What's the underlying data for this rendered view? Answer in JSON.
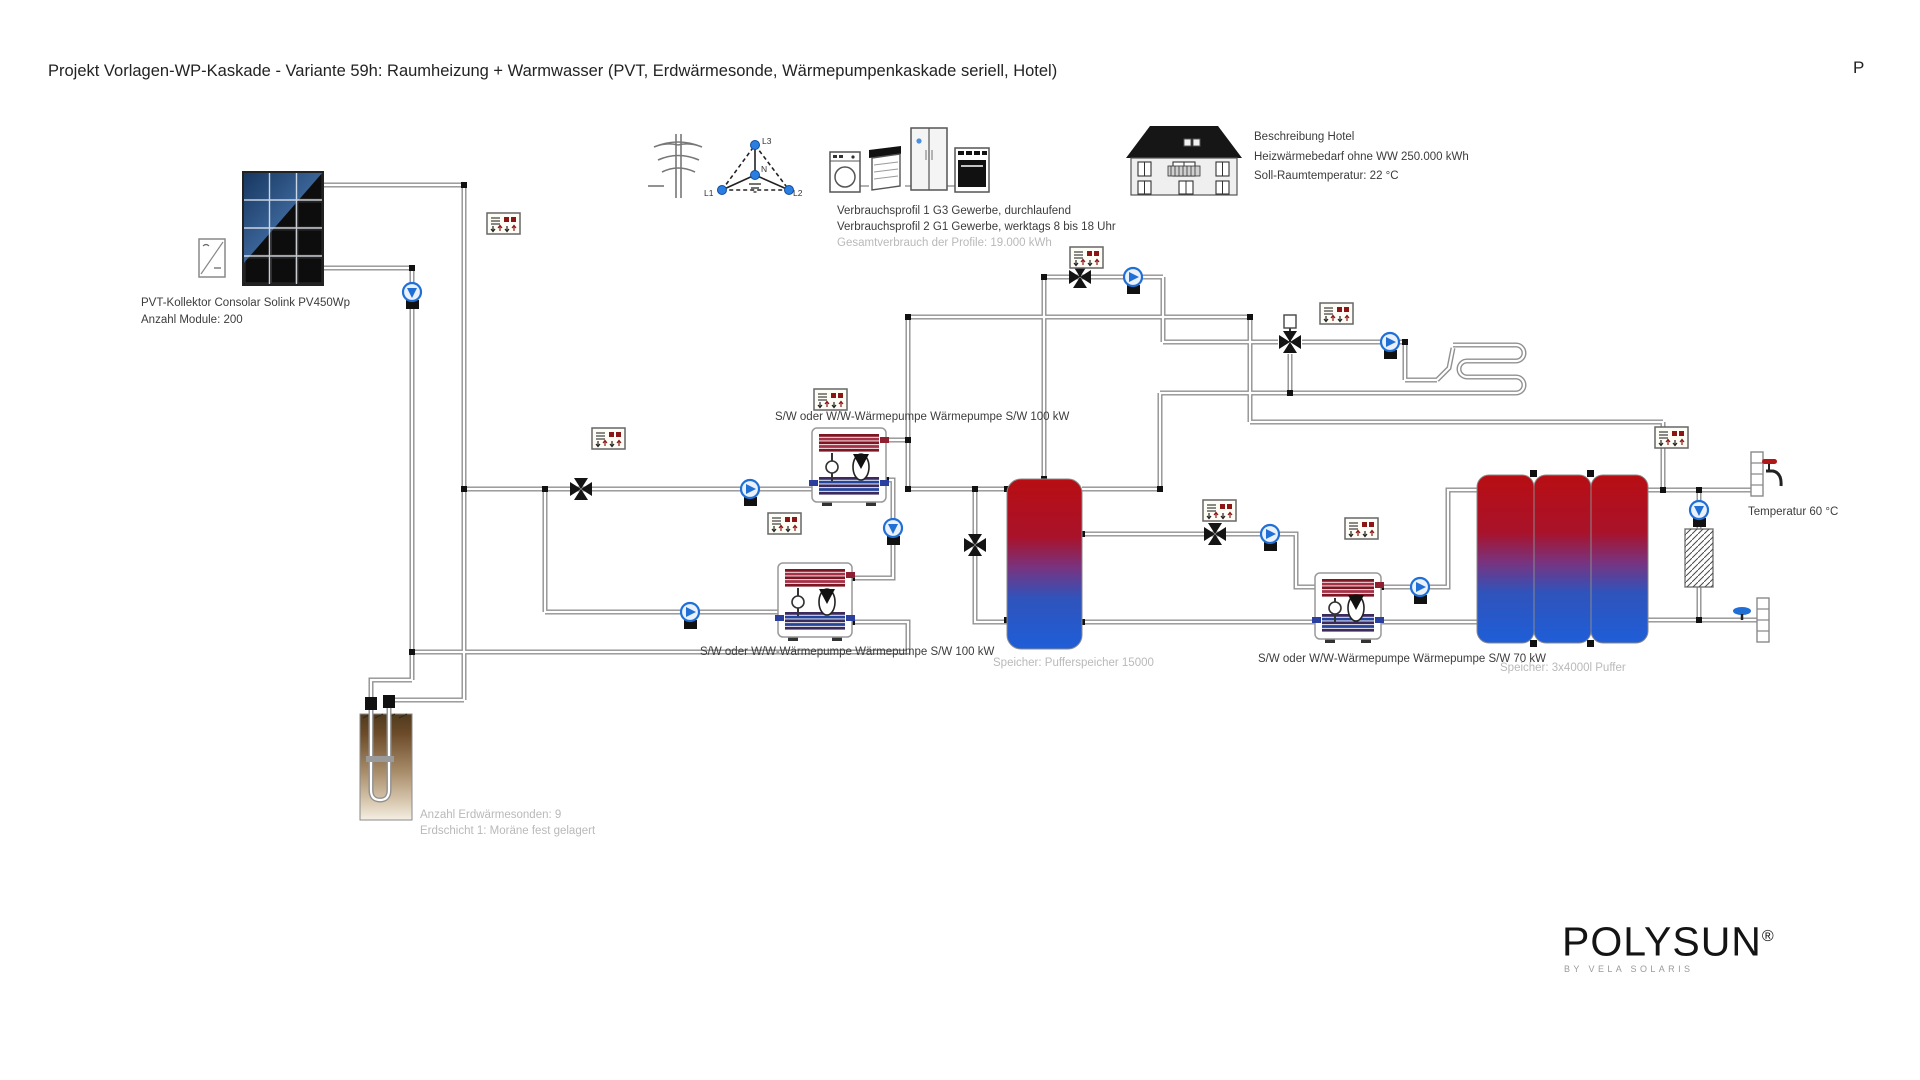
{
  "header": {
    "title": "Projekt Vorlagen-WP-Kaskade - Variante 59h: Raumheizung + Warmwasser (PVT, Erdwärmesonde, Wärmepumpenkaskade seriell, Hotel)",
    "corner_text": "P"
  },
  "pvt": {
    "line1": "PVT-Kollektor Consolar Solink PV450Wp",
    "line2": "Anzahl Module: 200"
  },
  "grid": {
    "l1": "L1",
    "l2": "L2",
    "l3": "L3",
    "n": "N"
  },
  "consumption": {
    "line1": "Verbrauchsprofil 1 G3 Gewerbe, durchlaufend",
    "line2": "Verbrauchsprofil 2 G1 Gewerbe, werktags 8 bis 18 Uhr",
    "line3": "Gesamtverbrauch der Profile: 19.000 kWh"
  },
  "building": {
    "line1": "Beschreibung Hotel",
    "line2": "Heizwärmebedarf ohne WW 250.000 kWh",
    "line3": "Soll-Raumtemperatur: 22 °C"
  },
  "heat_pumps": {
    "hp1": "S/W oder W/W-Wärmepumpe Wärmepumpe S/W 100 kW",
    "hp2": "S/W oder W/W-Wärmepumpe Wärmepumpe S/W 100 kW",
    "hp3": "S/W oder W/W-Wärmepumpe Wärmepumpe S/W 70 kW"
  },
  "storage": {
    "tank1": "Speicher: Pufferspeicher 15000",
    "tank2": "Speicher: 3x4000l Puffer"
  },
  "dhw": {
    "temperature": "Temperatur 60 °C"
  },
  "ground": {
    "line1": "Anzahl Erdwärmesonden: 9",
    "line2": "Erdschicht 1: Moräne fest gelagert"
  },
  "logo": {
    "name": "POLYSUN",
    "reg": "®",
    "subtitle": "BY VELA SOLARIS"
  },
  "colors": {
    "tank_hot": "#b80e13",
    "tank_cold": "#1e5ed8",
    "pipe": "#909090",
    "pump_blue": "#1f6fd6",
    "controller_red": "#8c1616",
    "ground_brown": "#5f4426"
  }
}
